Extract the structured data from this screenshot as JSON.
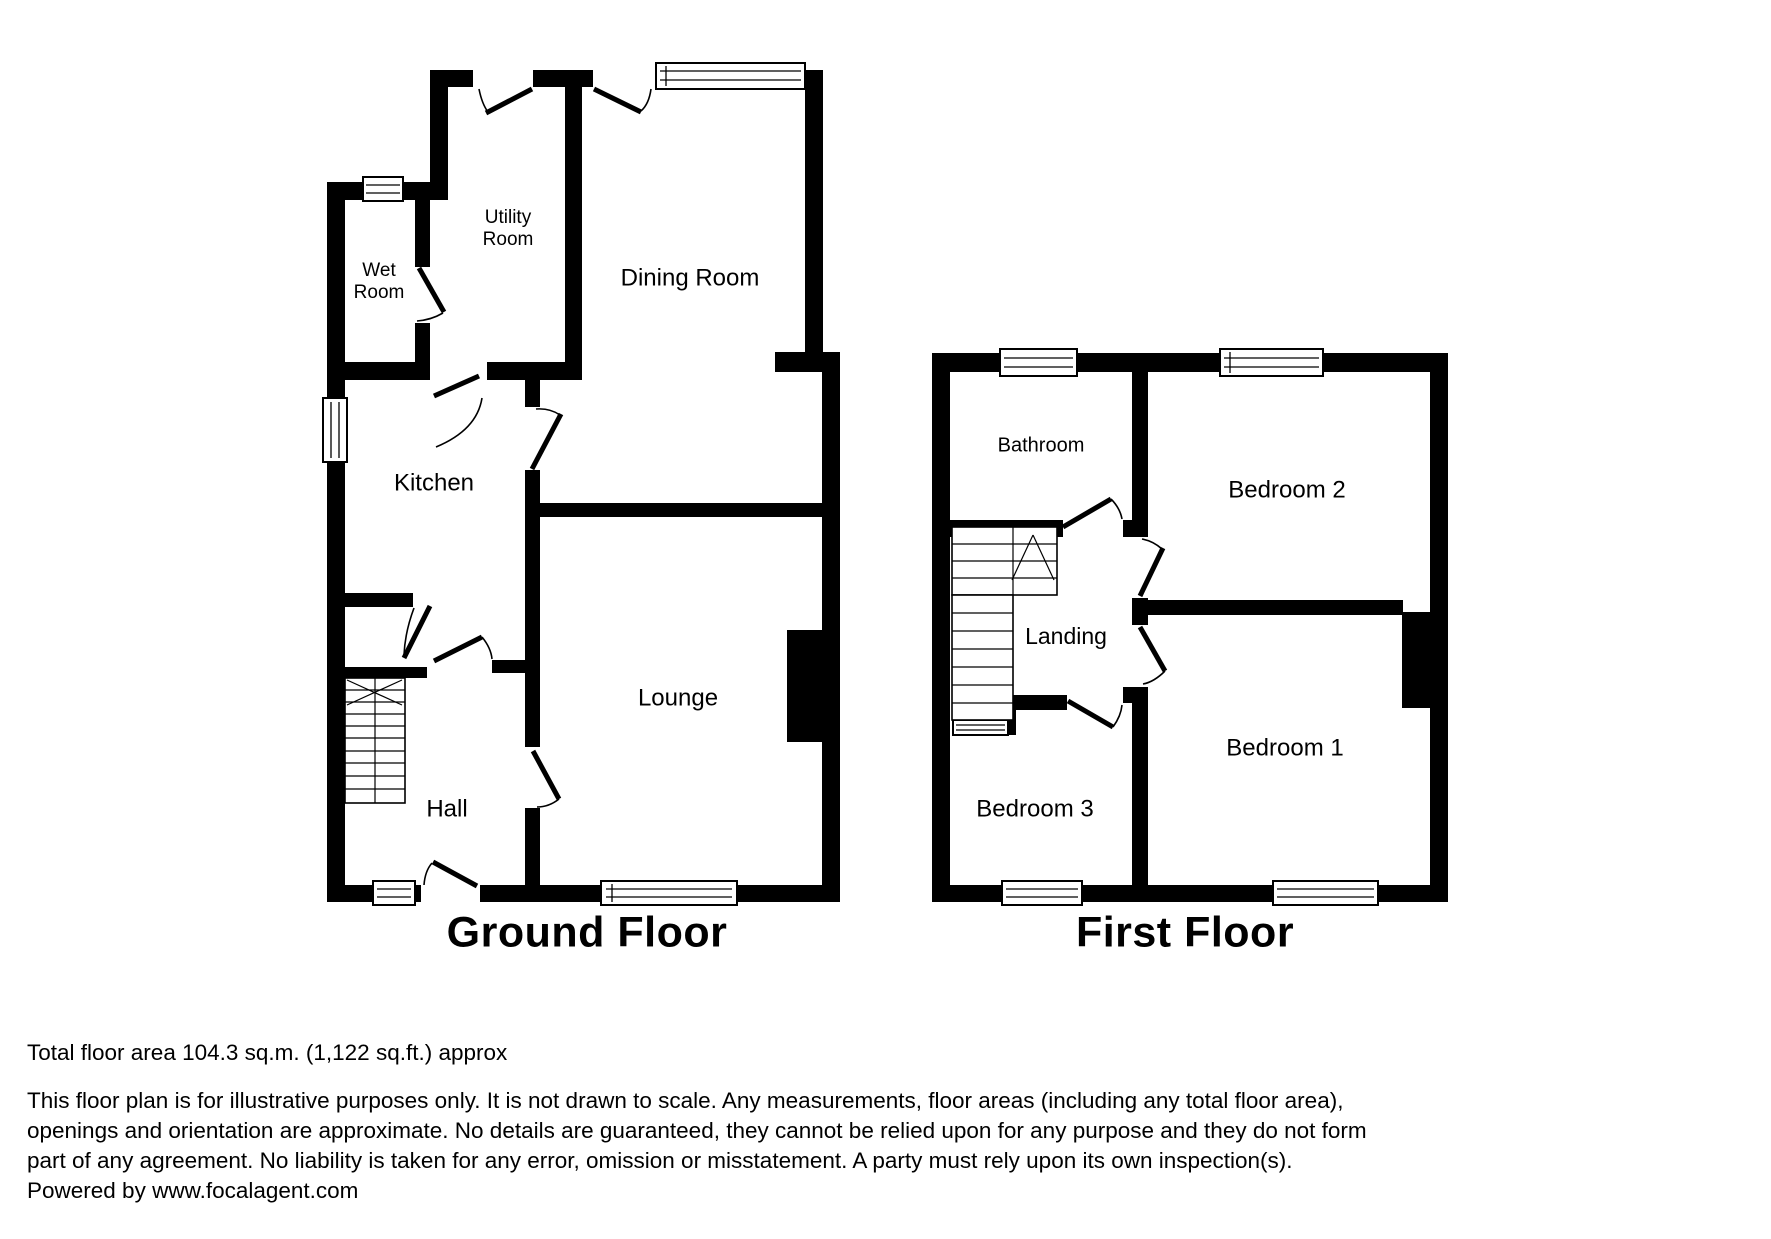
{
  "colors": {
    "wall": "#000000",
    "background": "#ffffff",
    "text": "#000000"
  },
  "ground_floor": {
    "title": "Ground Floor",
    "rooms": {
      "wet_room": {
        "line1": "Wet",
        "line2": "Room"
      },
      "utility_room": {
        "line1": "Utility",
        "line2": "Room"
      },
      "dining_room": "Dining Room",
      "kitchen": "Kitchen",
      "lounge": "Lounge",
      "hall": "Hall"
    }
  },
  "first_floor": {
    "title": "First Floor",
    "rooms": {
      "bathroom": "Bathroom",
      "bedroom2": "Bedroom 2",
      "landing": "Landing",
      "bedroom1": "Bedroom 1",
      "bedroom3": "Bedroom 3"
    }
  },
  "footer": {
    "total_area": "Total floor area 104.3 sq.m. (1,122 sq.ft.) approx",
    "disclaimer_lines": [
      "This floor plan is for illustrative purposes only. It is not drawn to scale. Any measurements, floor areas (including any total floor area),",
      "openings and orientation are approximate. No details are guaranteed, they cannot be relied upon for any purpose and they do not form",
      "part of any agreement. No liability is taken for any error, omission or misstatement. A party must rely upon its own inspection(s).",
      "Powered by www.focalagent.com"
    ]
  }
}
